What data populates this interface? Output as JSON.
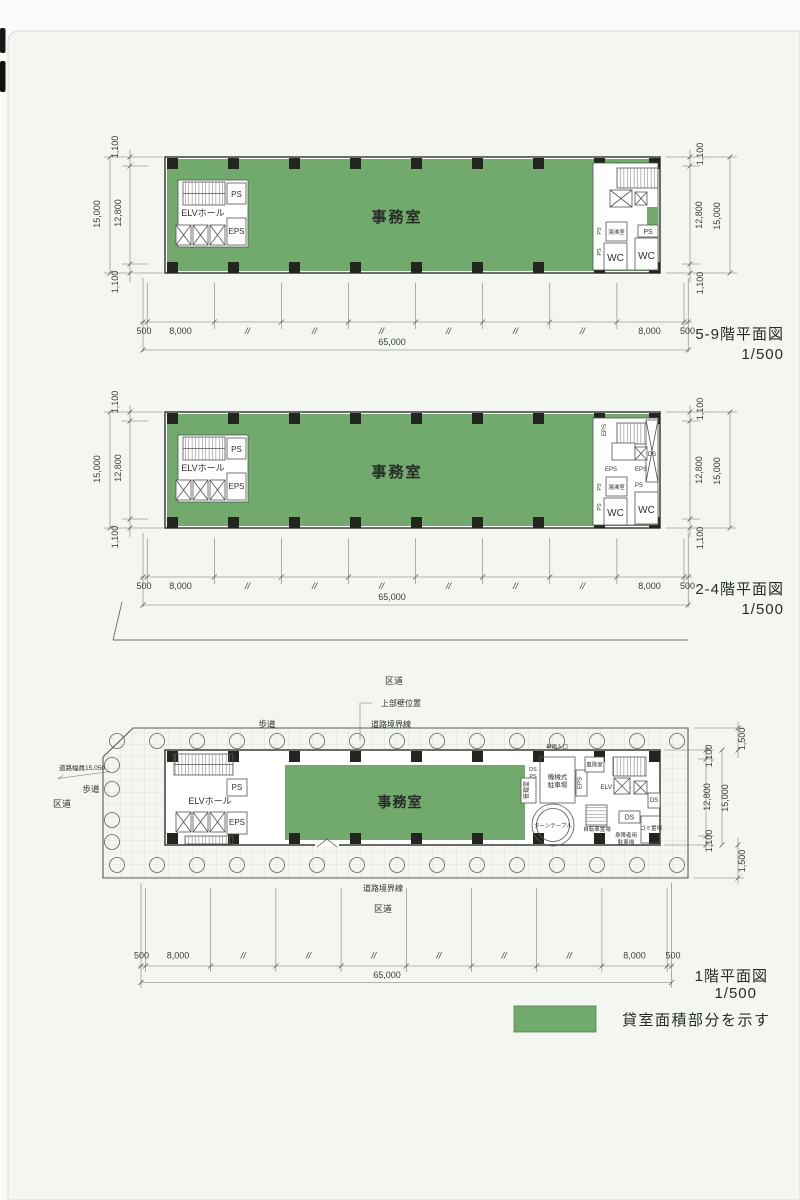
{
  "colors": {
    "rental_green": "#72a96d",
    "paper": "#f3f6f1",
    "ink": "#2e332d"
  },
  "labels": {
    "office": "事務室",
    "elv_hall": "ELVホール",
    "ps": "PS",
    "eps": "EPS",
    "wc": "WC",
    "ds": "DS",
    "hot_water_room": "湯沸室",
    "d500": "500",
    "d8000": "8,000",
    "d65000": "65,000",
    "d1100": "1,100",
    "d12800": "12,800",
    "d15000": "15,000",
    "d1500": "1,500",
    "ditto": "//"
  },
  "plans": {
    "floor5_9": {
      "title": "5-9階平面図",
      "scale": "1/500"
    },
    "floor2_4": {
      "title": "2-4階平面図",
      "scale": "1/500"
    },
    "floor1": {
      "title": "1階平面図",
      "scale": "1/500"
    }
  },
  "site": {
    "ward_road": "区道",
    "sidewalk": "歩道",
    "road_boundary": "道路境界線",
    "upper_wall_position": "上部壁位置",
    "road_width": "道路幅員15,050",
    "vehicle_entrance": "車両入口",
    "windbreak_room": "風除室",
    "mechanical_parking_line1": "機械式",
    "mechanical_parking_line2": "駐車場",
    "control_room": "管理室",
    "turntable": "ターンテーブル",
    "bicycle_parking": "自転車置場",
    "disabled_parking_line1": "身障者用",
    "disabled_parking_line2": "駐車場",
    "garbage_area": "ゴミ置場"
  },
  "legend": {
    "label": "貸室面積部分を示す",
    "swatch_color": "#72a96d"
  }
}
